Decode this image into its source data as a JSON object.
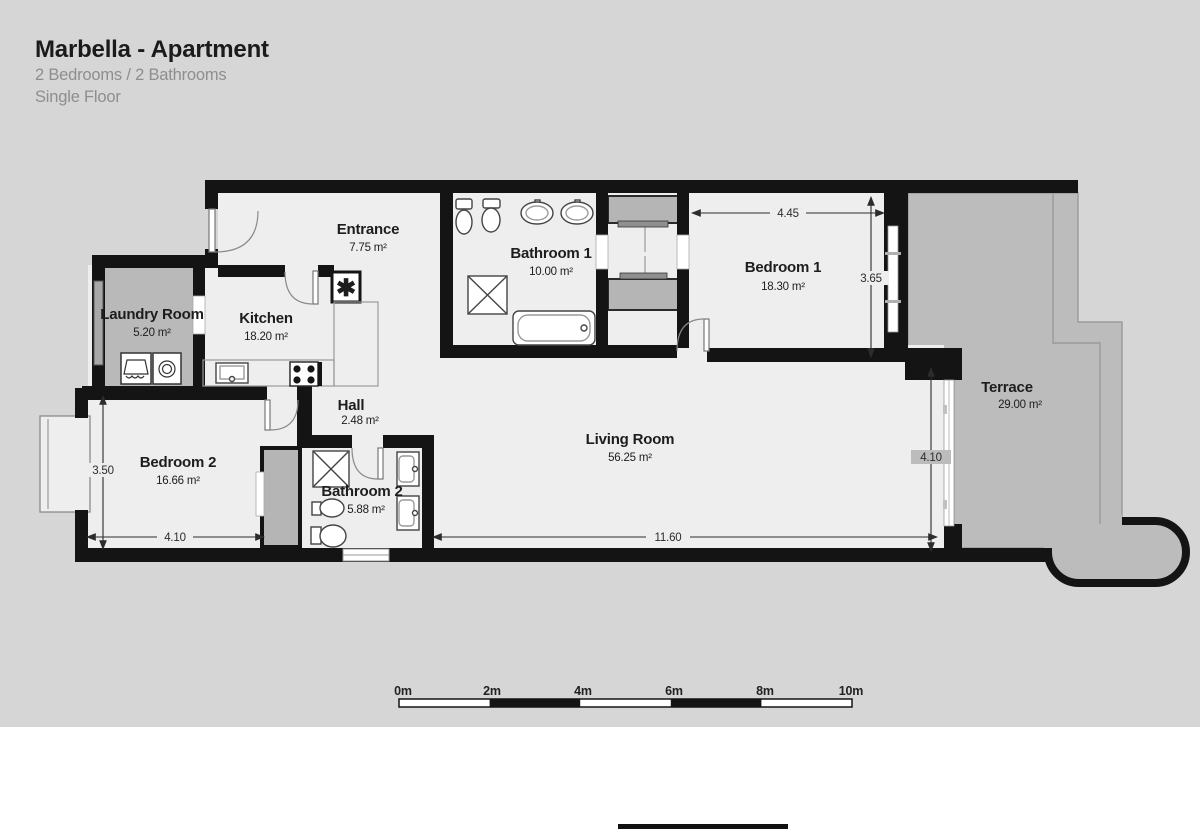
{
  "header": {
    "title": "Marbella - Apartment",
    "subtitle": "2 Bedrooms / 2 Bathrooms",
    "floor": "Single Floor"
  },
  "rooms": {
    "entrance": {
      "name": "Entrance",
      "area": "7.75 m²"
    },
    "bathroom1": {
      "name": "Bathroom 1",
      "area": "10.00 m²"
    },
    "bedroom1": {
      "name": "Bedroom 1",
      "area": "18.30 m²"
    },
    "terrace": {
      "name": "Terrace",
      "area": "29.00 m²"
    },
    "laundry": {
      "name": "Laundry Room",
      "area": "5.20 m²"
    },
    "kitchen": {
      "name": "Kitchen",
      "area": "18.20 m²"
    },
    "hall": {
      "name": "Hall",
      "area": "2.48 m²"
    },
    "bedroom2": {
      "name": "Bedroom 2",
      "area": "16.66 m²"
    },
    "bathroom2": {
      "name": "Bathroom 2",
      "area": "5.88 m²"
    },
    "living": {
      "name": "Living Room",
      "area": "56.25 m²"
    }
  },
  "dimensions": {
    "bedroom1_width": "4.45",
    "bedroom1_height": "3.65",
    "bedroom2_height": "3.50",
    "bedroom2_width": "4.10",
    "living_width": "11.60",
    "living_height": "4.10"
  },
  "scale_bar": {
    "labels": [
      "0m",
      "2m",
      "4m",
      "6m",
      "8m",
      "10m"
    ]
  },
  "symbols": {
    "utility": "✱"
  },
  "colors": {
    "wall": "#141414",
    "floor": "#efeeee",
    "terrace": "#bcbcbc",
    "background": "#d6d6d6",
    "closet_gray": "#b5b5b5",
    "text_dark": "#1d1d1d",
    "text_muted": "#8e8e8e"
  }
}
